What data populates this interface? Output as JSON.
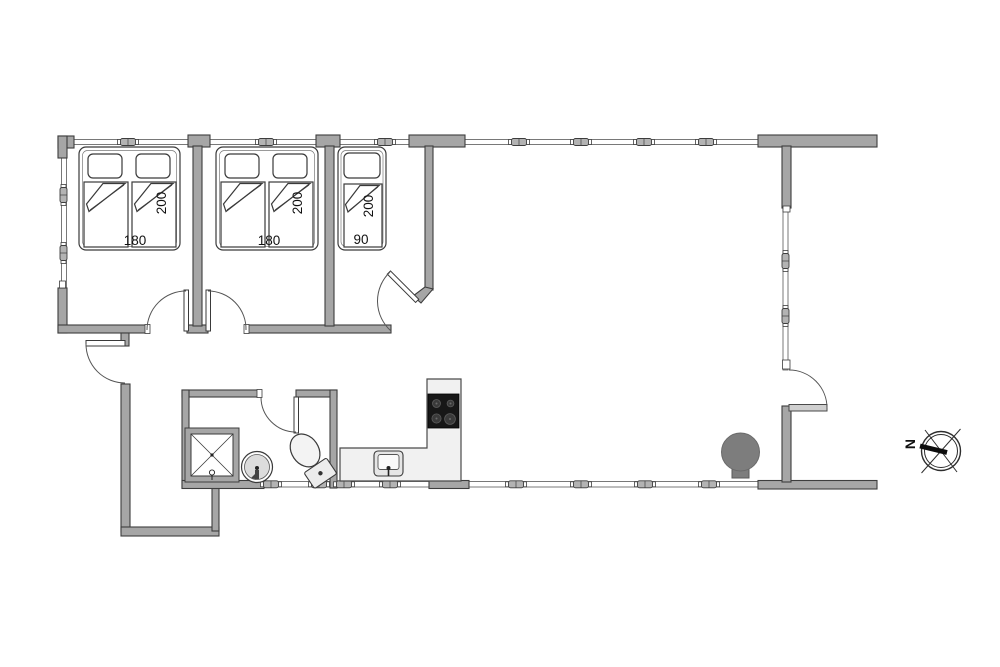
{
  "plan": {
    "beds": {
      "bed1": {
        "width": "180",
        "length": "200"
      },
      "bed2": {
        "width": "180",
        "length": "200"
      },
      "bed3": {
        "width": "90",
        "length": "200"
      }
    },
    "compass": {
      "north_label": "N"
    }
  },
  "colors": {
    "wall_fill": "#a6a6a6",
    "wall_stroke": "#3d3d3d",
    "counter_fill": "#f1f1f1",
    "stove_fill": "#171717",
    "wood_stove_fill": "#7d7d7d",
    "background": "#ffffff"
  }
}
